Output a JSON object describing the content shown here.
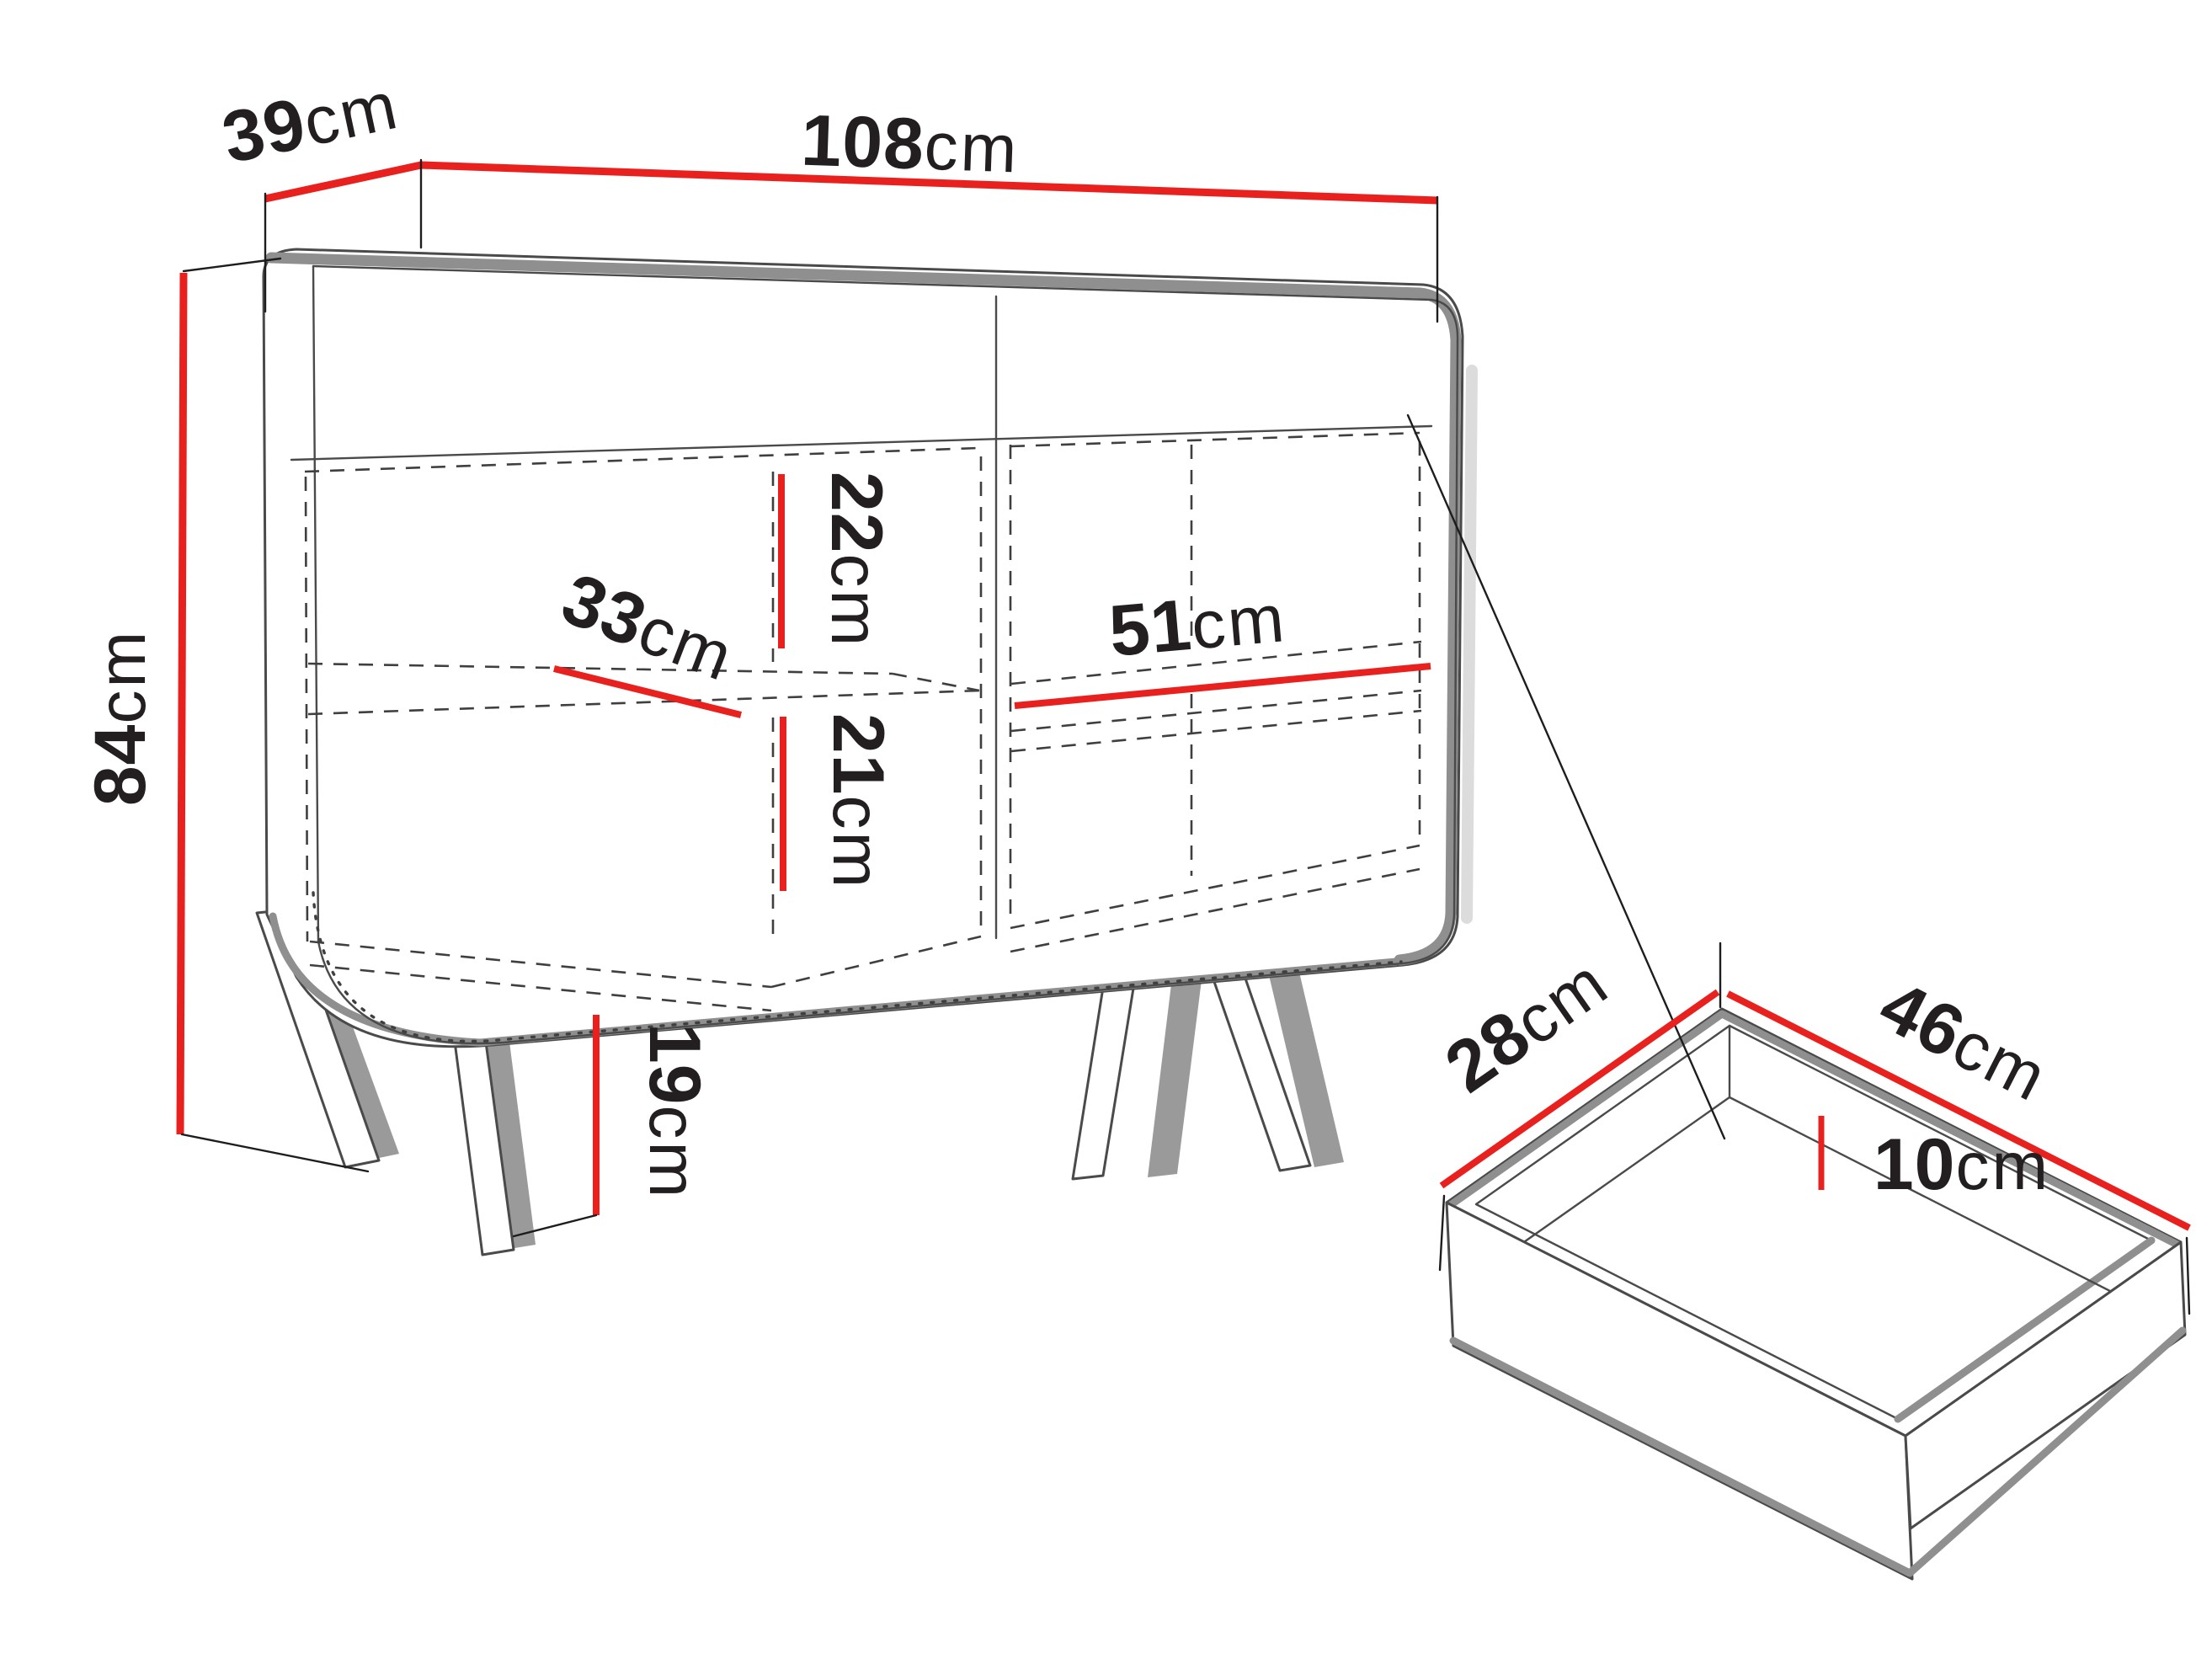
{
  "figure": {
    "kind": "furniture-dimension-diagram",
    "subject": "sideboard cabinet with legs, interior shelves and a pulled-out drawer",
    "background_color": "#ffffff"
  },
  "colors": {
    "dimension_red": "#e8201e",
    "outline_dark": "#4a4a4a",
    "shade_gray": "#8f8f8f",
    "text_black": "#231f20"
  },
  "dimensions": {
    "depth": {
      "value": "39",
      "unit": "cm",
      "applies_to": "cabinet top depth (left edge)"
    },
    "width": {
      "value": "108",
      "unit": "cm",
      "applies_to": "cabinet overall width (top edge)"
    },
    "height": {
      "value": "84",
      "unit": "cm",
      "applies_to": "cabinet overall height (left side)"
    },
    "upper_compartment": {
      "value": "22",
      "unit": "cm",
      "applies_to": "left compartment height above shelf"
    },
    "shelf_depth": {
      "value": "33",
      "unit": "cm",
      "applies_to": "shelf depth (left compartment)"
    },
    "right_compartment": {
      "value": "51",
      "unit": "cm",
      "applies_to": "right compartment shelf width"
    },
    "lower_compartment": {
      "value": "21",
      "unit": "cm",
      "applies_to": "left compartment height below shelf"
    },
    "leg_height": {
      "value": "19",
      "unit": "cm",
      "applies_to": "leg height"
    },
    "drawer_depth": {
      "value": "28",
      "unit": "cm",
      "applies_to": "drawer depth (left top edge)"
    },
    "drawer_width": {
      "value": "46",
      "unit": "cm",
      "applies_to": "drawer width (right top edge)"
    },
    "drawer_height": {
      "value": "10",
      "unit": "cm",
      "applies_to": "drawer inner height"
    }
  }
}
